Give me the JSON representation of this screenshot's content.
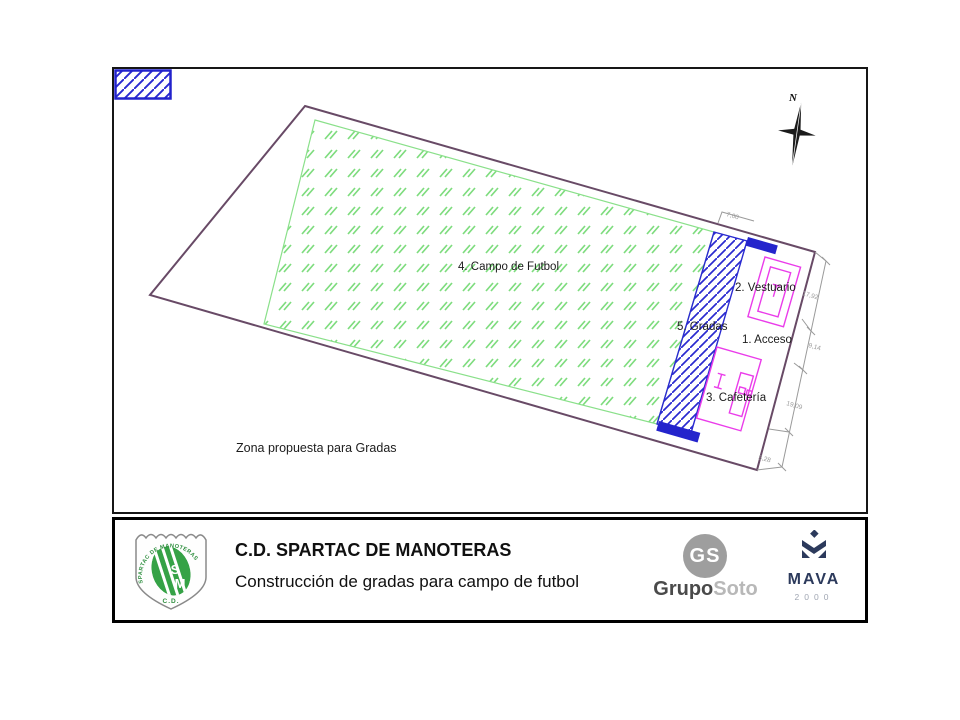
{
  "plan": {
    "north_label": "N",
    "labels": {
      "campo": "4. Campo de Futbol",
      "gradas": "5. Gradas",
      "vestuario": "2. Vestuario",
      "acceso": "1. Acceso",
      "cafeteria": "3. Cafetería"
    },
    "dimensions": {
      "top": "7,00",
      "vestuario": "17,92",
      "acceso": "9,14",
      "cafeteria": "19,09",
      "bottom": "5,28"
    },
    "legend": {
      "label": "Zona propuesta para  Gradas"
    },
    "colors": {
      "site_boundary": "#684a66",
      "field_green": "#7edc7e",
      "gradas_blue": "#2a2ad0",
      "building_magenta": "#ea3cea",
      "dimension_gray": "#9a9a9a"
    }
  },
  "title_block": {
    "title": "C.D. SPARTAC DE MANOTERAS",
    "subtitle": "Construcción de gradas para campo de futbol",
    "crest": {
      "arc_text": "SPARTAC DE MANOTERAS",
      "letter_s": "S",
      "letter_m": "M",
      "bottom_text": "C.D."
    },
    "grupo_soto": {
      "emblem": "GS",
      "name_dark": "Grupo",
      "name_light": "Soto"
    },
    "mava": {
      "name": "MAVA",
      "year": "2000"
    }
  }
}
